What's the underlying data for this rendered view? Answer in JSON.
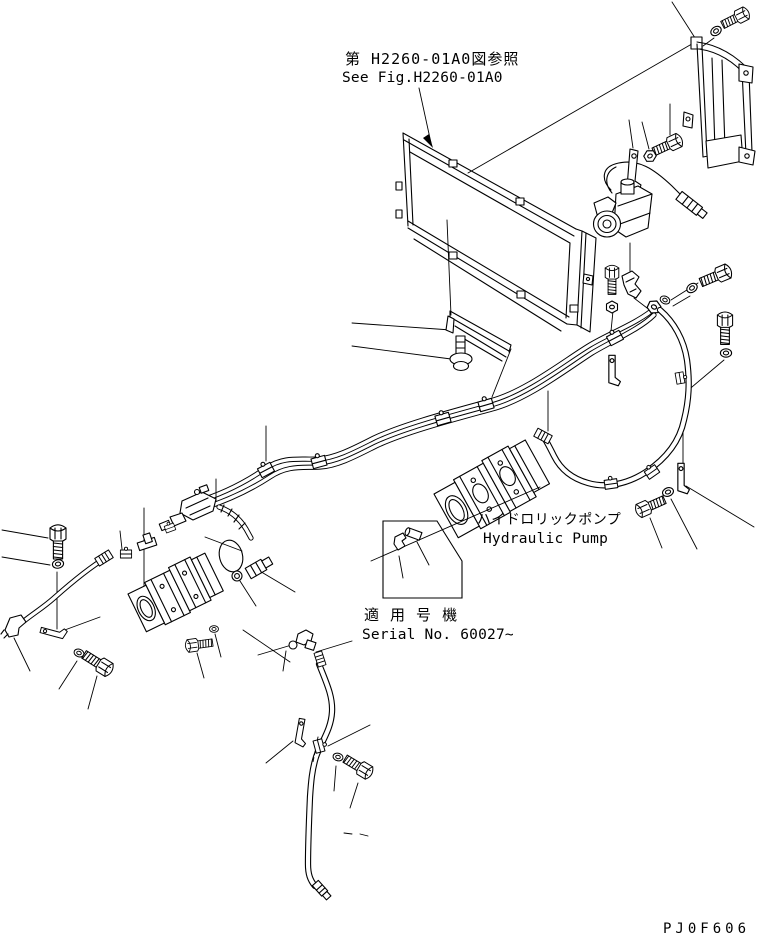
{
  "figure": {
    "fig_ref_jp": "第 H2260-01A0図参照",
    "fig_ref_en": "See Fig.H2260-01A0",
    "pump_label_jp": "ハイドロリックポンプ",
    "pump_label_en": "Hydraulic Pump",
    "serial_label_jp": "適 用 号 機",
    "serial_label_en": "Serial No. 60027~",
    "part_code": "PJ0F606"
  },
  "colors": {
    "line": "#000000",
    "background": "#ffffff"
  }
}
